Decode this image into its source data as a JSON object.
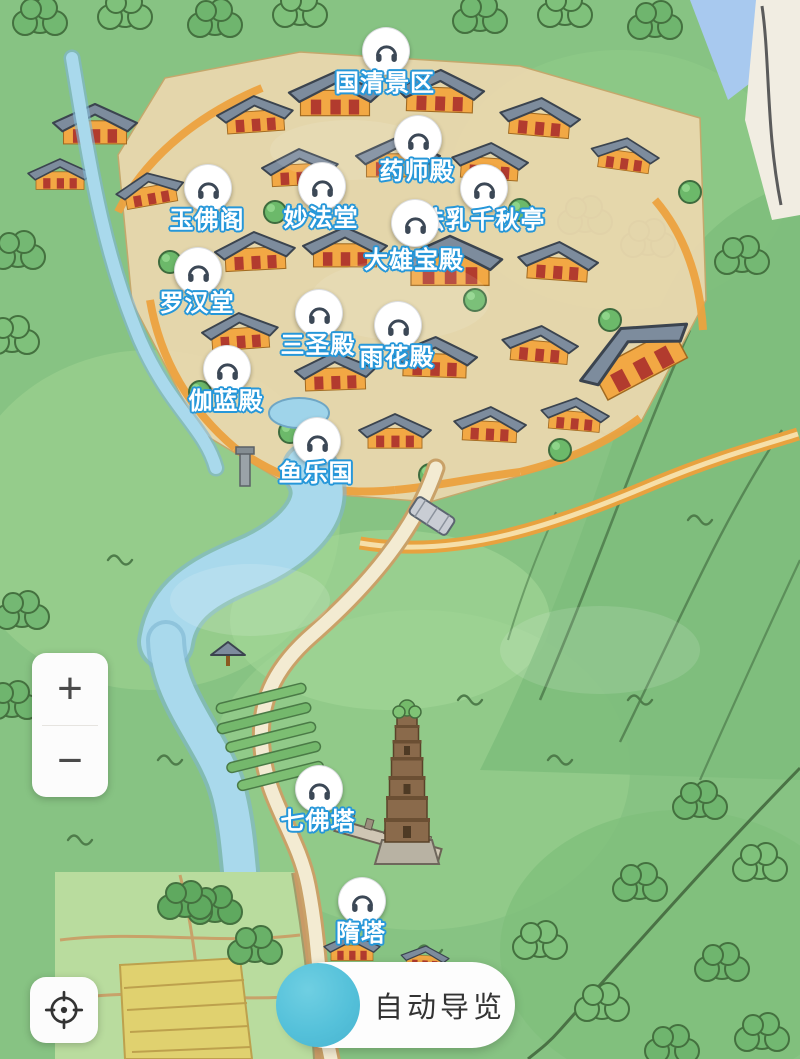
{
  "screen": {
    "title": "scenic-area-hand-drawn-map",
    "size": {
      "width": 800,
      "height": 1059
    }
  },
  "map": {
    "poi_icon": "headphones-icon",
    "pois": [
      {
        "id": "guoqing-scenic-area",
        "label": "国清景区",
        "x": 385,
        "y": 50
      },
      {
        "id": "yaoshi-hall",
        "label": "药师殿",
        "x": 417,
        "y": 138
      },
      {
        "id": "yufo-pavilion",
        "label": "玉佛阁",
        "x": 207,
        "y": 187
      },
      {
        "id": "miaofa-hall",
        "label": "妙法堂",
        "x": 321,
        "y": 185
      },
      {
        "id": "faru-qianqiu-pavilion",
        "label": "法乳千秋亭",
        "x": 483,
        "y": 187
      },
      {
        "id": "daxiongbao-hall",
        "label": "大雄宝殿",
        "x": 414,
        "y": 222,
        "label_dy": 39
      },
      {
        "id": "luohan-hall",
        "label": "罗汉堂",
        "x": 197,
        "y": 270
      },
      {
        "id": "sansheng-hall",
        "label": "三圣殿",
        "x": 318,
        "y": 312
      },
      {
        "id": "yuhua-hall",
        "label": "雨花殿",
        "x": 397,
        "y": 324
      },
      {
        "id": "qielan-hall",
        "label": "伽蓝殿",
        "x": 226,
        "y": 368
      },
      {
        "id": "yuleguo",
        "label": "鱼乐国",
        "x": 316,
        "y": 440
      },
      {
        "id": "qifo-pagoda",
        "label": "七佛塔",
        "x": 318,
        "y": 788
      },
      {
        "id": "sui-pagoda",
        "label": "隋塔",
        "x": 361,
        "y": 900
      }
    ]
  },
  "controls": {
    "zoom_in_label": "+",
    "zoom_out_label": "−",
    "locate_icon": "crosshair-icon"
  },
  "bottom_bar": {
    "label": "自动导览"
  },
  "colors": {
    "poi_label_fill": "#FFFFFF",
    "poi_label_stroke": "#2697D9",
    "marker_glyph": "#3C4856",
    "auto_tour_circle": "#55C1DA",
    "control_glyph": "#4A4A4A",
    "map_base_green": "#87C383",
    "river_blue": "#A9D9EC",
    "path_cream": "#F3EBD2",
    "wall_orange": "#ECA23F",
    "roof_gray": "#7D8C9D"
  }
}
